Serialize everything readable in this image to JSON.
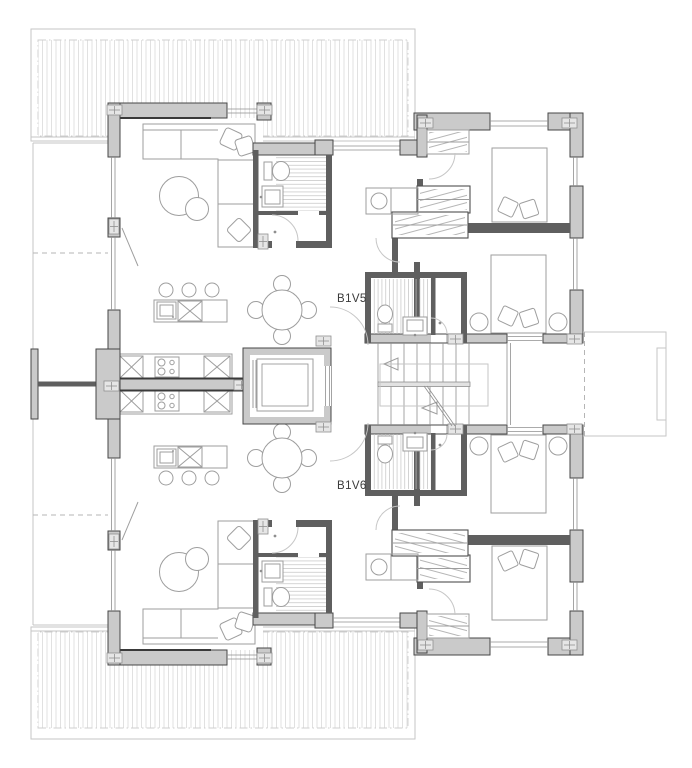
{
  "page": {
    "background": "#ffffff"
  },
  "plan": {
    "unit_labels": {
      "top": "B1V5",
      "bottom": "B1V6"
    },
    "colors": {
      "wall_fill": "#cacaca",
      "wall_outline": "#474747",
      "wall_dark": "#5f5f5f",
      "furniture_line": "#9e9e9e",
      "hatch_line": "#dedede",
      "shower_hatch": "#c2c2c2",
      "label_text": "#3a3a3a",
      "light_outline": "#c6c6c6",
      "dashed_line": "#b5b5b5"
    },
    "icons": {
      "fixtures": [
        "elevator-icon",
        "stairs-icon",
        "toilet-icon",
        "sink-icon",
        "shower-icon",
        "stove-icon",
        "kitchen-island-icon",
        "dining-table-icon",
        "sofa-icon",
        "bed-icon",
        "wardrobe-icon",
        "washing-machine-icon",
        "terrace-deck-icon",
        "door-swing-icon",
        "survey-marker-icon"
      ]
    }
  }
}
